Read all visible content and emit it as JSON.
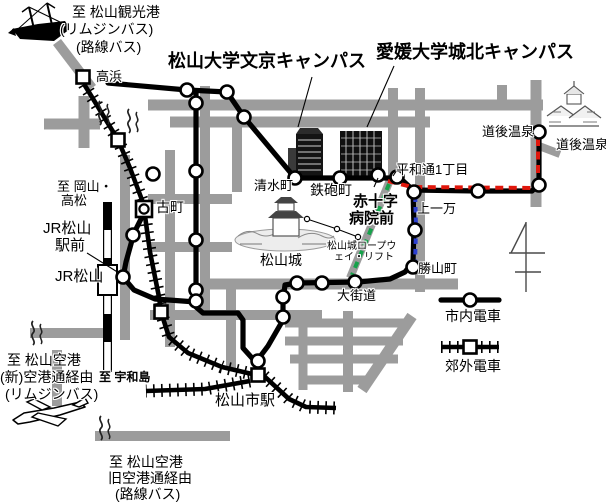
{
  "map": {
    "colors": {
      "road": "#9c9c9c",
      "line": "#000000",
      "route_red": "#e0170c",
      "route_blue": "#2b3fd0",
      "route_green": "#17a24b"
    },
    "labels": [
      {
        "id": "to-kanko-port",
        "t": "至 松山観光港",
        "x": 72,
        "y": 5,
        "s": 14
      },
      {
        "id": "limousine-bus-1",
        "t": "(リムジンバス)",
        "x": 60,
        "y": 22,
        "s": 14
      },
      {
        "id": "rosen-bus-1",
        "t": "(路線バス)",
        "x": 76,
        "y": 40,
        "s": 14
      },
      {
        "id": "takahama",
        "t": "高浜",
        "x": 96,
        "y": 70,
        "s": 13
      },
      {
        "id": "matsuyama-univ-bunkyo",
        "t": "松山大学文京キャンパス",
        "x": 168,
        "y": 52,
        "s": 18,
        "b": 1
      },
      {
        "id": "ehime-univ-johoku",
        "t": "愛媛大学城北キャンパス",
        "x": 376,
        "y": 43,
        "s": 18,
        "b": 1
      },
      {
        "id": "dogo-onsen-station",
        "t": "道後温泉",
        "x": 482,
        "y": 125,
        "s": 13
      },
      {
        "id": "dogo-onsen-place",
        "t": "道後温泉",
        "x": 556,
        "y": 138,
        "s": 13
      },
      {
        "id": "shimizumachi",
        "t": "清水町",
        "x": 254,
        "y": 179,
        "s": 13
      },
      {
        "id": "teppocho",
        "t": "鉄砲町",
        "x": 310,
        "y": 183,
        "s": 14
      },
      {
        "id": "heiwadori-itchome",
        "t": "平和通1丁目",
        "x": 396,
        "y": 163,
        "s": 13
      },
      {
        "id": "sekijuji-line1",
        "t": "赤十字",
        "x": 353,
        "y": 194,
        "s": 15,
        "b": 1
      },
      {
        "id": "sekijuji-line2",
        "t": "病院前",
        "x": 349,
        "y": 211,
        "s": 15,
        "b": 1
      },
      {
        "id": "kamiichiman",
        "t": "上一万",
        "x": 417,
        "y": 202,
        "s": 13
      },
      {
        "id": "katsuyamacho",
        "t": "勝山町",
        "x": 418,
        "y": 262,
        "s": 13
      },
      {
        "id": "okaido",
        "t": "大街道",
        "x": 337,
        "y": 289,
        "s": 13
      },
      {
        "id": "matsuyamajo",
        "t": "松山城",
        "x": 260,
        "y": 253,
        "s": 14
      },
      {
        "id": "ropeway-line1",
        "t": "松山城ロープウ",
        "x": 327,
        "y": 242,
        "s": 10
      },
      {
        "id": "ropeway-line2",
        "t": "ェイ・リフト",
        "x": 334,
        "y": 253,
        "s": 10
      },
      {
        "id": "to-okayama-line1",
        "t": "至 岡山・",
        "x": 57,
        "y": 180,
        "s": 13
      },
      {
        "id": "to-okayama-line2",
        "t": "高松",
        "x": 61,
        "y": 194,
        "s": 13
      },
      {
        "id": "jr-ekimae-line1",
        "t": "JR松山",
        "x": 43,
        "y": 221,
        "s": 15
      },
      {
        "id": "jr-ekimae-line2",
        "t": "駅前",
        "x": 55,
        "y": 238,
        "s": 15
      },
      {
        "id": "jr-matsuyama",
        "t": "JR松山",
        "x": 55,
        "y": 269,
        "s": 15
      },
      {
        "id": "to-uwajima",
        "t": "至 宇和島",
        "x": 99,
        "y": 371,
        "s": 12,
        "b": 1
      },
      {
        "id": "komachi",
        "t": "古町",
        "x": 156,
        "y": 200,
        "s": 14
      },
      {
        "id": "matsuyama-shieki",
        "t": "松山市駅",
        "x": 215,
        "y": 393,
        "s": 15
      },
      {
        "id": "to-airport-new-1",
        "t": "至 松山空港",
        "x": 7,
        "y": 353,
        "s": 14
      },
      {
        "id": "to-airport-new-2",
        "t": "(新)空港通経由",
        "x": 0,
        "y": 370,
        "s": 14
      },
      {
        "id": "to-airport-new-3",
        "t": "(リムジンバス)",
        "x": 5,
        "y": 387,
        "s": 14
      },
      {
        "id": "to-airport-old-1",
        "t": "至 松山空港",
        "x": 109,
        "y": 455,
        "s": 14
      },
      {
        "id": "to-airport-old-2",
        "t": "旧空港通経由",
        "x": 108,
        "y": 471,
        "s": 14
      },
      {
        "id": "to-airport-old-3",
        "t": "(路線バス)",
        "x": 115,
        "y": 487,
        "s": 14
      },
      {
        "id": "legend-tram-label",
        "t": "市内電車",
        "x": 445,
        "y": 309,
        "s": 14
      },
      {
        "id": "legend-suburban-label",
        "t": "郊外電車",
        "x": 445,
        "y": 359,
        "s": 14
      }
    ],
    "roads": [
      {
        "pts": [
          [
            57,
            42
          ],
          [
            92,
            88
          ]
        ],
        "w": 10
      },
      {
        "pts": [
          [
            44,
            124
          ],
          [
            100,
            124
          ]
        ],
        "w": 11
      },
      {
        "pts": [
          [
            84,
            96
          ],
          [
            84,
            148
          ]
        ],
        "w": 11
      },
      {
        "pts": [
          [
            148,
            105
          ],
          [
            545,
            105
          ]
        ],
        "w": 11
      },
      {
        "pts": [
          [
            170,
            122
          ],
          [
            430,
            122
          ]
        ],
        "w": 11
      },
      {
        "pts": [
          [
            125,
            155
          ],
          [
            125,
            340
          ]
        ],
        "w": 10
      },
      {
        "pts": [
          [
            170,
            150
          ],
          [
            170,
            347
          ]
        ],
        "w": 10
      },
      {
        "pts": [
          [
            205,
            86
          ],
          [
            205,
            315
          ]
        ],
        "w": 10
      },
      {
        "pts": [
          [
            237,
            125
          ],
          [
            237,
            193
          ]
        ],
        "w": 10
      },
      {
        "pts": [
          [
            148,
            199
          ],
          [
            245,
            199
          ]
        ],
        "w": 10
      },
      {
        "pts": [
          [
            148,
            247
          ],
          [
            232,
            247
          ]
        ],
        "w": 10
      },
      {
        "pts": [
          [
            200,
            284
          ],
          [
            458,
            284
          ]
        ],
        "w": 11
      },
      {
        "pts": [
          [
            150,
            315
          ],
          [
            322,
            315
          ]
        ],
        "w": 10
      },
      {
        "pts": [
          [
            231,
            280
          ],
          [
            231,
            368
          ]
        ],
        "w": 10
      },
      {
        "pts": [
          [
            285,
            323
          ],
          [
            408,
            323
          ]
        ],
        "w": 9
      },
      {
        "pts": [
          [
            285,
            341
          ],
          [
            403,
            341
          ]
        ],
        "w": 9
      },
      {
        "pts": [
          [
            290,
            359
          ],
          [
            398,
            359
          ]
        ],
        "w": 9
      },
      {
        "pts": [
          [
            300,
            380
          ],
          [
            372,
            380
          ]
        ],
        "w": 9
      },
      {
        "pts": [
          [
            303,
            318
          ],
          [
            303,
            390
          ]
        ],
        "w": 9
      },
      {
        "pts": [
          [
            348,
            311
          ],
          [
            348,
            392
          ]
        ],
        "w": 10
      },
      {
        "pts": [
          [
            412,
            316
          ],
          [
            362,
            390
          ]
        ],
        "w": 11
      },
      {
        "pts": [
          [
            393,
            88
          ],
          [
            393,
            178
          ]
        ],
        "w": 10
      },
      {
        "pts": [
          [
            420,
            88
          ],
          [
            420,
            292
          ]
        ],
        "w": 10
      },
      {
        "pts": [
          [
            502,
            85
          ],
          [
            502,
            105
          ]
        ],
        "w": 10
      },
      {
        "pts": [
          [
            536,
            80
          ],
          [
            536,
            207
          ]
        ],
        "w": 11
      },
      {
        "pts": [
          [
            539,
            146
          ],
          [
            560,
            154
          ]
        ],
        "w": 8
      },
      {
        "pts": [
          [
            57,
            350
          ],
          [
            57,
            406
          ]
        ],
        "w": 10
      },
      {
        "pts": [
          [
            30,
            333
          ],
          [
            103,
            333
          ]
        ],
        "w": 10
      },
      {
        "pts": [
          [
            95,
            436
          ],
          [
            230,
            436
          ]
        ],
        "w": 10
      },
      {
        "pts": [
          [
            390,
            180
          ],
          [
            350,
            278
          ]
        ],
        "w": 8
      }
    ],
    "tram_lines": [
      {
        "pts": [
          [
            108,
            83
          ],
          [
            187,
            90
          ],
          [
            227,
            92
          ],
          [
            244,
            117
          ],
          [
            295,
            178
          ],
          [
            400,
            178
          ]
        ]
      },
      {
        "pts": [
          [
            400,
            178
          ],
          [
            413,
            190
          ],
          [
            478,
            191
          ],
          [
            532,
            191
          ],
          [
            539,
            184
          ],
          [
            539,
            132
          ]
        ]
      },
      {
        "pts": [
          [
            413,
            190
          ],
          [
            414,
            228
          ],
          [
            413,
            262
          ],
          [
            405,
            272
          ],
          [
            390,
            279
          ],
          [
            358,
            282
          ],
          [
            297,
            283
          ],
          [
            285,
            285
          ],
          [
            283,
            300
          ],
          [
            283,
            320
          ],
          [
            268,
            346
          ],
          [
            259,
            358
          ]
        ]
      },
      {
        "pts": [
          [
            196,
            93
          ],
          [
            196,
            307
          ],
          [
            203,
            313
          ],
          [
            238,
            313
          ],
          [
            243,
            320
          ],
          [
            243,
            348
          ],
          [
            252,
            358
          ],
          [
            258,
            362
          ]
        ]
      },
      {
        "pts": [
          [
            123,
            277
          ],
          [
            134,
            290
          ],
          [
            155,
            299
          ],
          [
            196,
            302
          ]
        ]
      },
      {
        "pts": [
          [
            144,
            213
          ],
          [
            134,
            233
          ],
          [
            126,
            262
          ],
          [
            123,
            277
          ]
        ]
      }
    ],
    "suburban_lines": [
      {
        "pts": [
          [
            84,
            84
          ],
          [
            112,
            130
          ],
          [
            118,
            140
          ],
          [
            130,
            168
          ],
          [
            142,
            200
          ],
          [
            144,
            207
          ]
        ]
      },
      {
        "pts": [
          [
            145,
            216
          ],
          [
            150,
            252
          ],
          [
            159,
            297
          ],
          [
            161,
            312
          ],
          [
            169,
            337
          ],
          [
            188,
            353
          ],
          [
            222,
            367
          ],
          [
            252,
            374
          ]
        ]
      },
      {
        "pts": [
          [
            250,
            381
          ],
          [
            205,
            389
          ],
          [
            146,
            391
          ]
        ]
      },
      {
        "pts": [
          [
            264,
            376
          ],
          [
            289,
            399
          ],
          [
            306,
            407
          ],
          [
            336,
            408
          ]
        ]
      }
    ],
    "jr_line": {
      "x": 107.5,
      "y1": 202,
      "y2": 372,
      "w": 9,
      "seg": 28,
      "station_rect": {
        "x": 98,
        "y": 265,
        "w": 19,
        "h": 30
      }
    },
    "routes": [
      {
        "color": "route_red",
        "pts": [
          [
            388,
            181
          ],
          [
            412,
            187
          ],
          [
            532,
            188
          ],
          [
            538,
            181
          ],
          [
            538,
            133
          ]
        ],
        "dash": "8 5.5"
      },
      {
        "color": "route_blue",
        "pts": [
          [
            415,
            186
          ],
          [
            416,
            228
          ],
          [
            415,
            265
          ]
        ],
        "dash": "5.5 5"
      },
      {
        "color": "route_green",
        "pts": [
          [
            389,
            184
          ],
          [
            372,
            227
          ],
          [
            352,
            275
          ]
        ],
        "dash": "6.5 5.5"
      }
    ],
    "stations_circle": [
      {
        "x": 187,
        "y": 90
      },
      {
        "x": 227,
        "y": 92
      },
      {
        "x": 196,
        "y": 103
      },
      {
        "x": 244,
        "y": 117
      },
      {
        "x": 153,
        "y": 174
      },
      {
        "x": 196,
        "y": 171
      },
      {
        "x": 133,
        "y": 235
      },
      {
        "x": 196,
        "y": 240
      },
      {
        "x": 123,
        "y": 277,
        "n": "jr-matsuyama-ekimae"
      },
      {
        "x": 196,
        "y": 290
      },
      {
        "x": 196,
        "y": 301
      },
      {
        "x": 295,
        "y": 178,
        "n": "shimizumachi"
      },
      {
        "x": 340,
        "y": 178,
        "n": "teppocho"
      },
      {
        "x": 378,
        "y": 175,
        "n": "sekijuji-byoin-mae"
      },
      {
        "x": 397,
        "y": 177,
        "n": "heiwadori-itchome"
      },
      {
        "x": 414,
        "y": 192,
        "n": "kamiichiman"
      },
      {
        "x": 415,
        "y": 230
      },
      {
        "x": 413,
        "y": 267,
        "n": "katsuyamacho"
      },
      {
        "x": 478,
        "y": 191
      },
      {
        "x": 539,
        "y": 185
      },
      {
        "x": 539,
        "y": 132,
        "n": "dogo-onsen"
      },
      {
        "x": 355,
        "y": 282,
        "n": "okaido"
      },
      {
        "x": 322,
        "y": 283
      },
      {
        "x": 297,
        "y": 283
      },
      {
        "x": 283,
        "y": 297
      },
      {
        "x": 283,
        "y": 317
      },
      {
        "x": 258,
        "y": 361,
        "n": "matsuyama-shieki"
      }
    ],
    "stations_square": [
      {
        "x": 83,
        "y": 77,
        "n": "takahama"
      },
      {
        "x": 118,
        "y": 140
      },
      {
        "x": 161,
        "y": 312
      },
      {
        "x": 258,
        "y": 375,
        "n": "matsuyama-shieki-suburban"
      }
    ],
    "interchange_komachi": {
      "x": 144,
      "y": 209
    },
    "pointer_lines": [
      [
        312,
        77,
        298,
        127
      ],
      [
        394,
        66,
        367,
        127
      ],
      [
        87,
        253,
        119,
        273
      ],
      [
        374,
        187,
        378,
        178
      ],
      [
        397,
        170,
        393,
        176
      ]
    ],
    "ropeway": {
      "pts": [
        [
          307,
          219
        ],
        [
          337,
          229
        ],
        [
          358,
          237
        ]
      ]
    },
    "north_symbol": [
      [
        526,
        222,
        526,
        292
      ],
      [
        526,
        223,
        511,
        253
      ],
      [
        509,
        253,
        545,
        253
      ],
      [
        515,
        272,
        541,
        272
      ]
    ],
    "hot_springs": [
      [
        100,
        101
      ],
      [
        129,
        109
      ],
      [
        33,
        321
      ],
      [
        101,
        416
      ]
    ],
    "legend": {
      "tram_symbol": {
        "x1": 441,
        "x2": 499,
        "y": 300,
        "cx": 470
      },
      "suburban_symbol": {
        "x1": 441,
        "x2": 499,
        "y": 347,
        "cx": 470
      }
    }
  }
}
